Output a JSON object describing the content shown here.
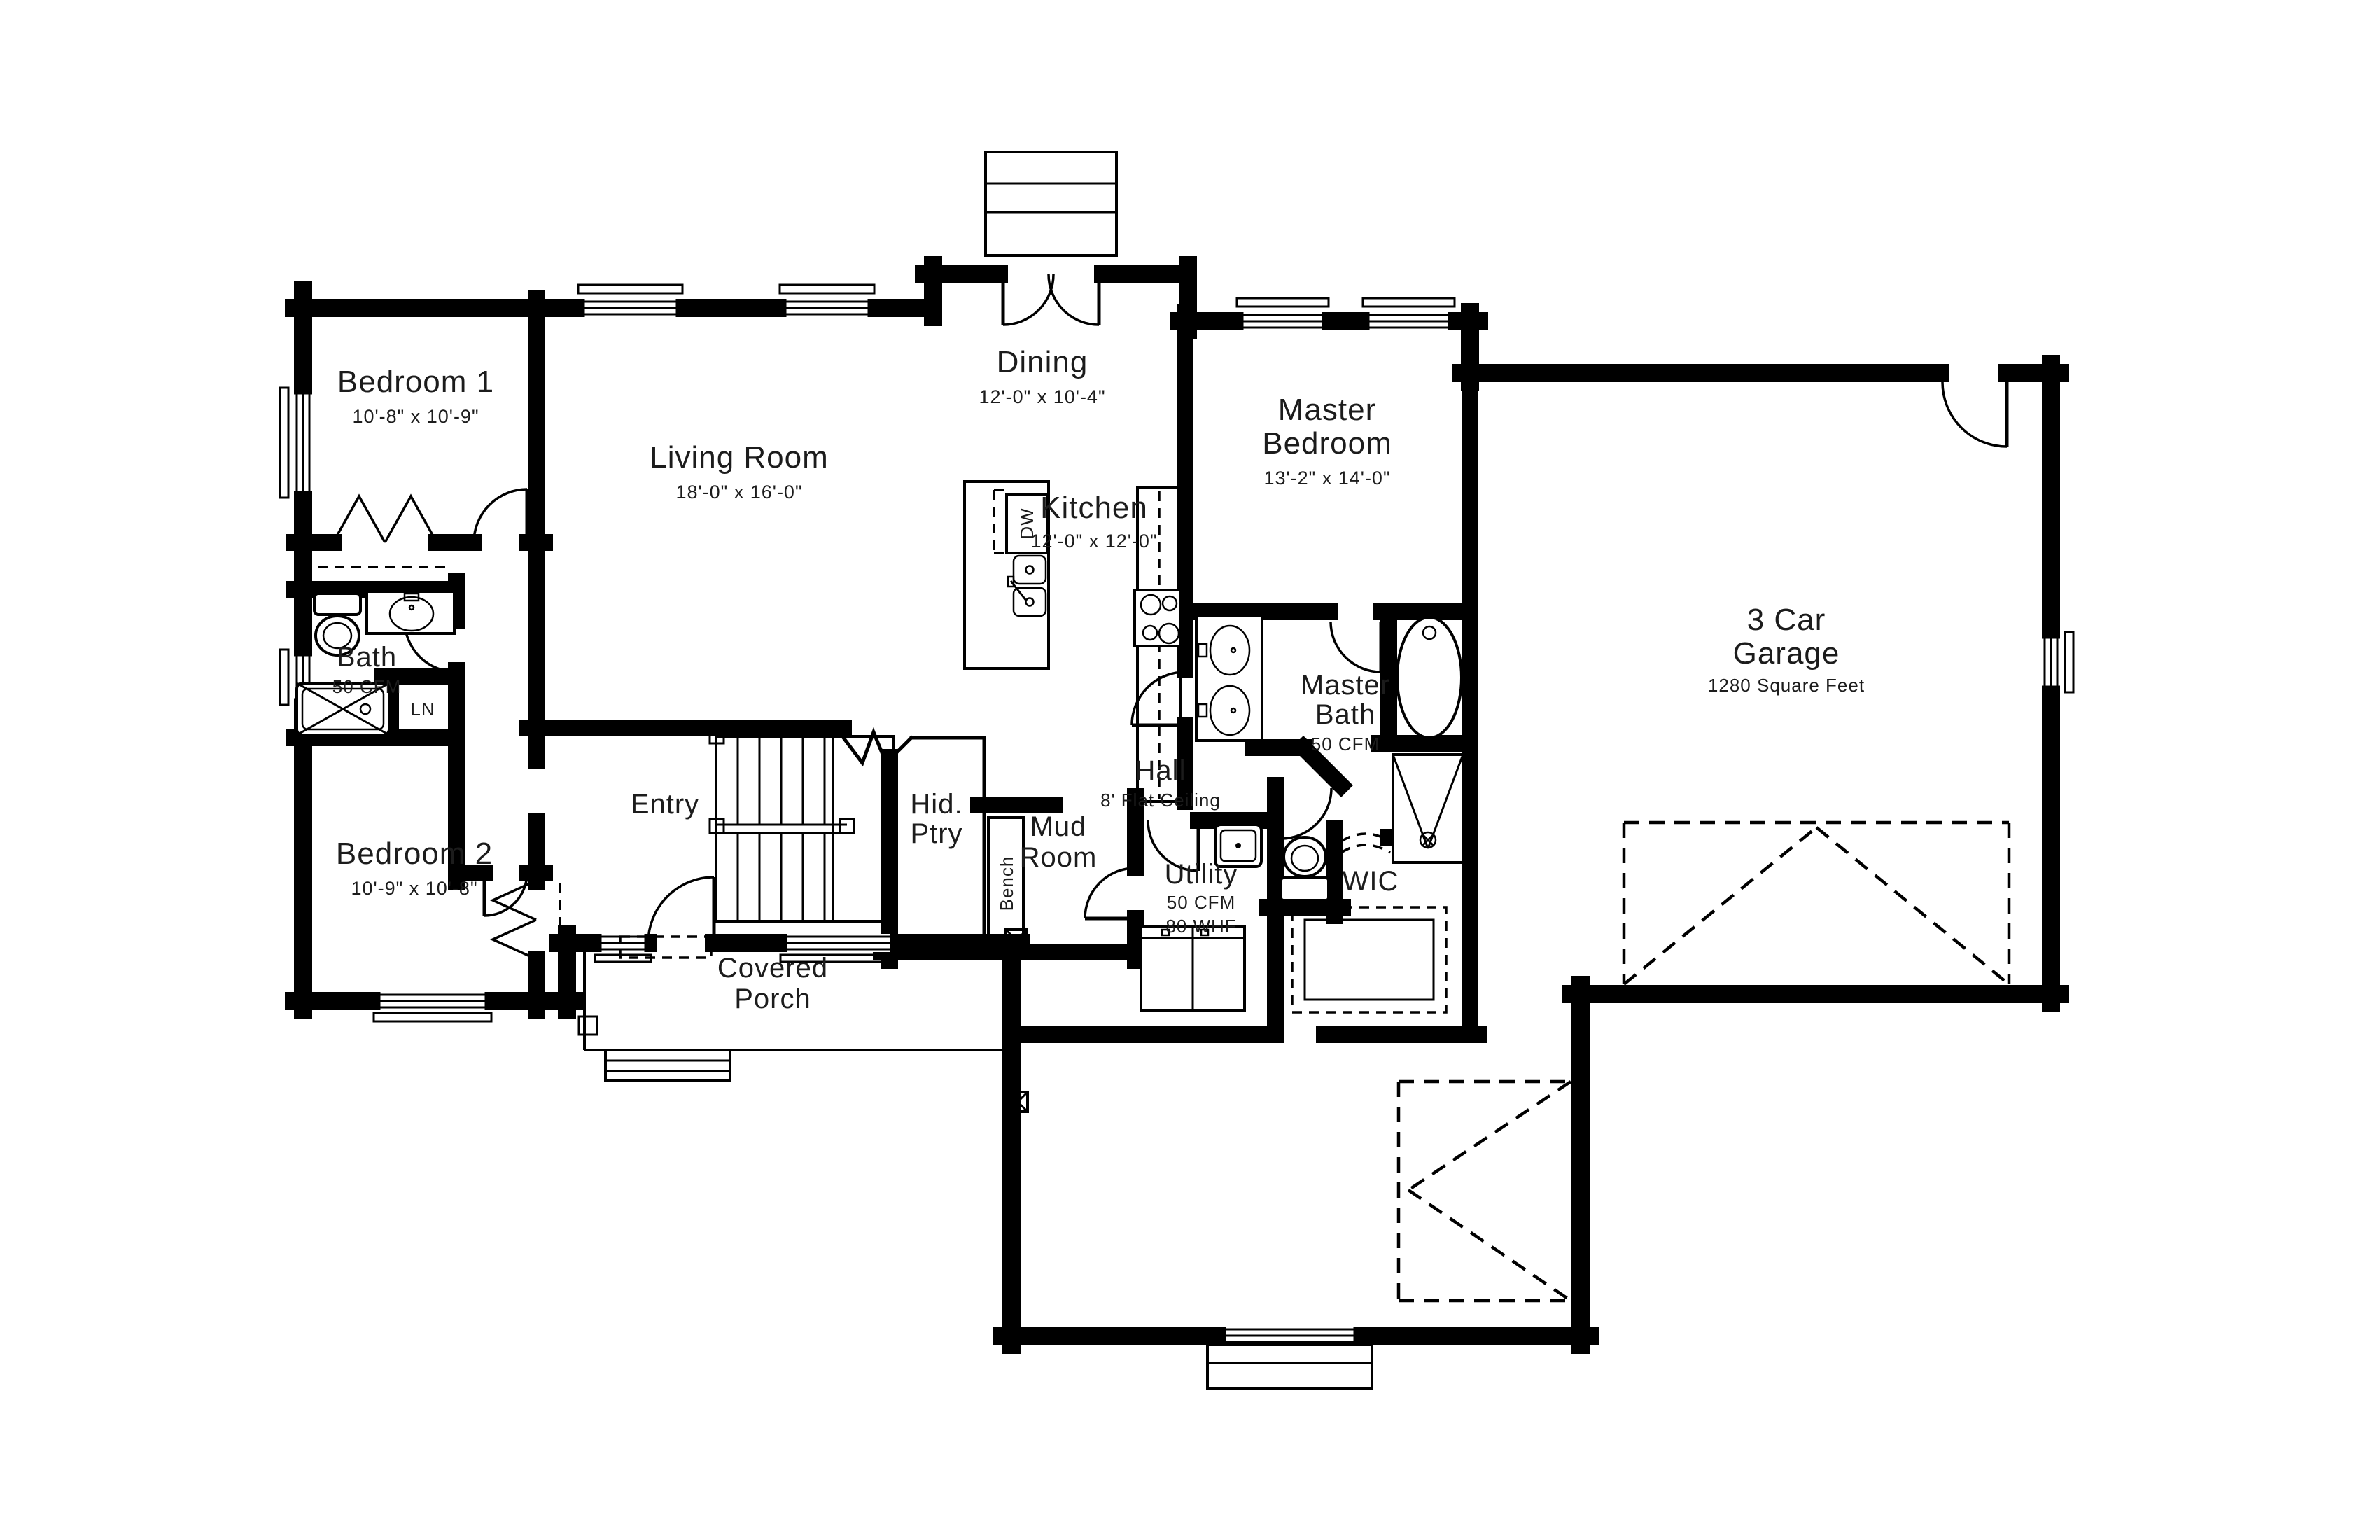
{
  "page": {
    "background": "#ffffff",
    "line_color": "#000000"
  },
  "rooms": {
    "bedroom1": {
      "name": "Bedroom 1",
      "dims": "10'-8\" x 10'-9\""
    },
    "living_room": {
      "name": "Living Room",
      "dims": "18'-0\" x 16'-0\""
    },
    "dining": {
      "name": "Dining",
      "dims": "12'-0\" x 10'-4\""
    },
    "kitchen": {
      "name": "Kitchen",
      "dims": "12'-0\" x 12'-0\""
    },
    "master_bedroom": {
      "name_line1": "Master",
      "name_line2": "Bedroom",
      "dims": "13'-2\" x 14'-0\""
    },
    "garage": {
      "name_line1": "3 Car",
      "name_line2": "Garage",
      "area": "1280 Square Feet"
    },
    "bath": {
      "name": "Bath",
      "vent": "50 CFM"
    },
    "master_bath": {
      "name_line1": "Master",
      "name_line2": "Bath",
      "vent": "50 CFM"
    },
    "entry": {
      "name": "Entry"
    },
    "hidden_pantry": {
      "name_line1": "Hid.",
      "name_line2": "Ptry"
    },
    "hall": {
      "name": "Hall",
      "note": "8' Flat Ceiling"
    },
    "mud_room": {
      "name_line1": "Mud",
      "name_line2": "Room",
      "bench": "Bench"
    },
    "utility": {
      "name": "Utility",
      "vent": "50 CFM",
      "fan": "80 WHF"
    },
    "wic": {
      "name": "WIC"
    },
    "bedroom2": {
      "name": "Bedroom 2",
      "dims": "10'-9\" x 10'-8\""
    },
    "covered_porch": {
      "name_line1": "Covered",
      "name_line2": "Porch"
    },
    "linen": {
      "abbr": "LN"
    },
    "appliances": {
      "dishwasher": "DW"
    }
  }
}
